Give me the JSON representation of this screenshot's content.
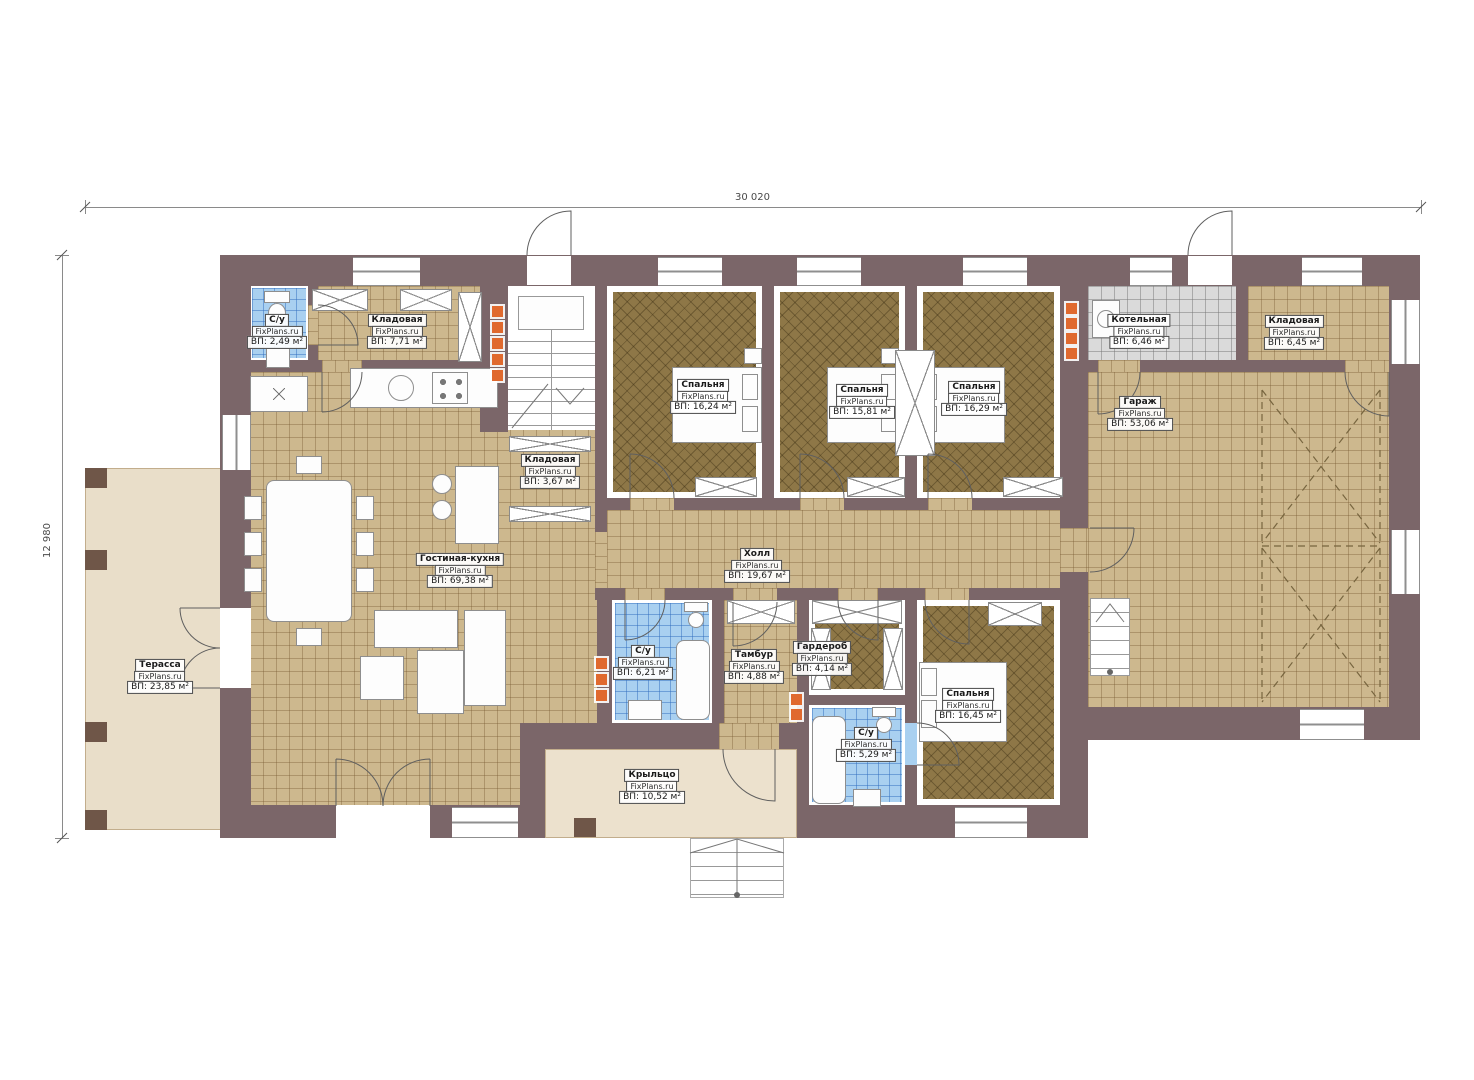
{
  "watermark": "FixPlans.ru",
  "dimensions": {
    "width": "30 020",
    "height": "12 980"
  },
  "rooms": {
    "terrace": {
      "name": "Терасса",
      "area": "ВП: 23,85 м²"
    },
    "su_top": {
      "name": "С/у",
      "area": "ВП: 2,49 м²"
    },
    "klad_top": {
      "name": "Кладовая",
      "area": "ВП: 7,71 м²"
    },
    "klad_small": {
      "name": "Кладовая",
      "area": "ВП: 3,67 м²"
    },
    "living": {
      "name": "Гостиная-кухня",
      "area": "ВП: 69,38 м²"
    },
    "bedroom1": {
      "name": "Спальня",
      "area": "ВП: 16,24 м²"
    },
    "bedroom2": {
      "name": "Спальня",
      "area": "ВП: 15,81 м²"
    },
    "bedroom3": {
      "name": "Спальня",
      "area": "ВП: 16,29 м²"
    },
    "hall": {
      "name": "Холл",
      "area": "ВП: 19,67 м²"
    },
    "boiler": {
      "name": "Котельная",
      "area": "ВП: 6,46 м²"
    },
    "klad_right": {
      "name": "Кладовая",
      "area": "ВП: 6,45 м²"
    },
    "garage": {
      "name": "Гараж",
      "area": "ВП: 53,06 м²"
    },
    "su_mid": {
      "name": "С/у",
      "area": "ВП: 6,21 м²"
    },
    "tambur": {
      "name": "Тамбур",
      "area": "ВП: 4,88 м²"
    },
    "garderob": {
      "name": "Гардероб",
      "area": "ВП: 4,14 м²"
    },
    "bedroom4": {
      "name": "Спальня",
      "area": "ВП: 16,45 м²"
    },
    "su_bottom": {
      "name": "С/у",
      "area": "ВП: 5,29 м²"
    },
    "porch": {
      "name": "Крыльцо",
      "area": "ВП: 10,52 м²"
    }
  },
  "colors": {
    "wall": "#7b6669",
    "floor_tile": "#cdb88e",
    "floor_bedroom": "#8e7747",
    "floor_bath": "#a9d0f0",
    "floor_boiler": "#dadada",
    "terrace": "#e9dec9",
    "radiator": "#e0692e"
  }
}
